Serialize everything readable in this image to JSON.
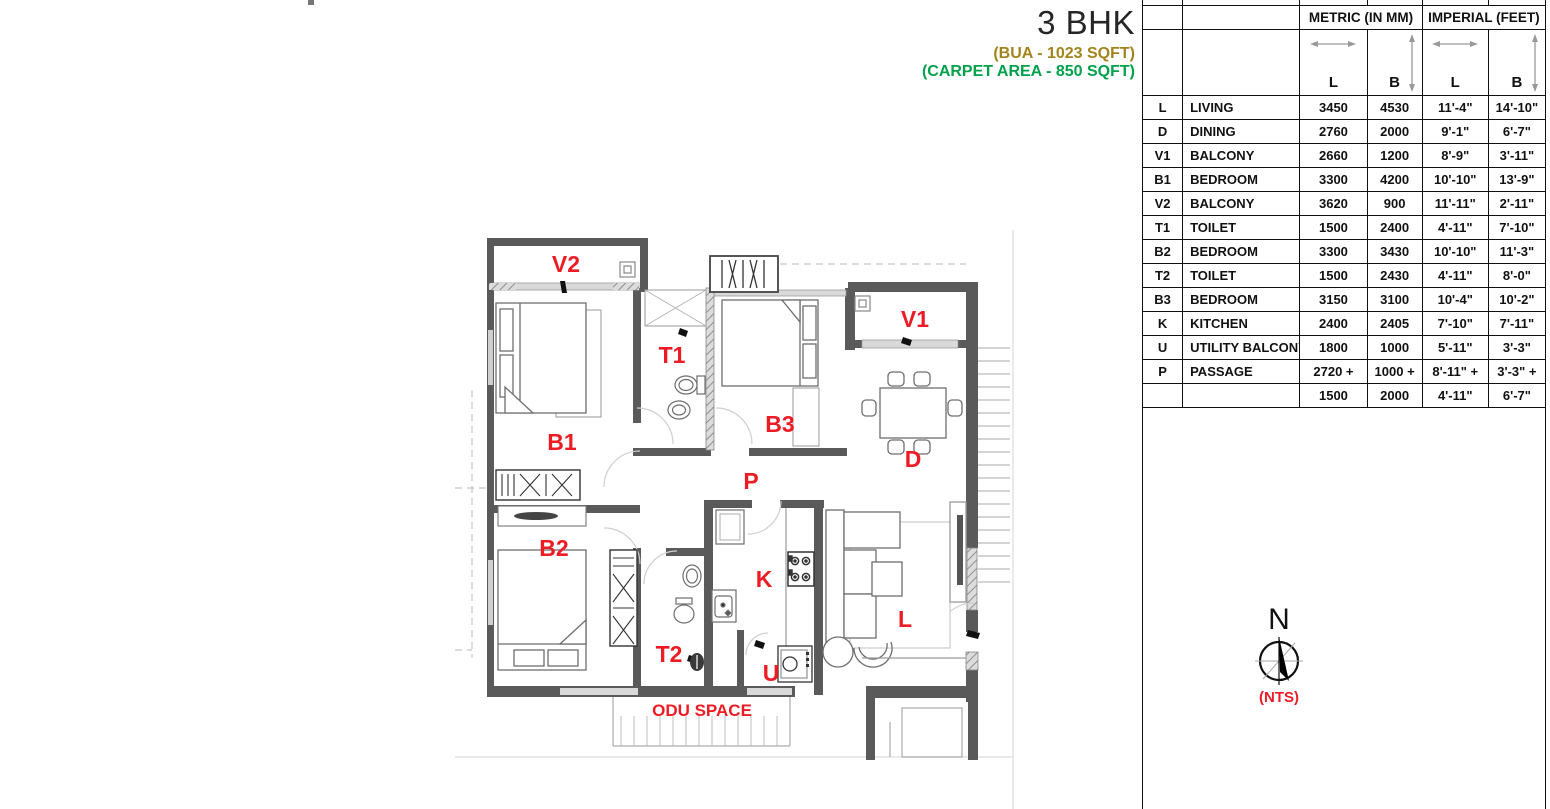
{
  "title": {
    "heading": "3 BHK",
    "bua": "(BUA - 1023 SQFT)",
    "carpet": "(CARPET AREA - 850 SQFT)"
  },
  "colors": {
    "label_red": "#ed1c24",
    "bua_gold": "#a3841c",
    "carpet_green": "#00a14b",
    "wall_gray": "#5a5a5a"
  },
  "plan": {
    "labels": {
      "v2": "V2",
      "b1": "B1",
      "t1": "T1",
      "b3": "B3",
      "v1": "V1",
      "d": "D",
      "p": "P",
      "b2": "B2",
      "t2": "T2",
      "k": "K",
      "u": "U",
      "l": "L"
    },
    "odu_space": "ODU SPACE"
  },
  "compass": {
    "north": "N",
    "scale_note": "(NTS)"
  },
  "table": {
    "group_headers": [
      "METRIC (IN MM)",
      "IMPERIAL (FEET)"
    ],
    "sub_headers": [
      "L",
      "B",
      "L",
      "B"
    ],
    "rows": [
      [
        "L",
        "LIVING",
        "3450",
        "4530",
        "11'-4\"",
        "14'-10\""
      ],
      [
        "D",
        "DINING",
        "2760",
        "2000",
        "9'-1\"",
        "6'-7\""
      ],
      [
        "V1",
        "BALCONY",
        "2660",
        "1200",
        "8'-9\"",
        "3'-11\""
      ],
      [
        "B1",
        "BEDROOM",
        "3300",
        "4200",
        "10'-10\"",
        "13'-9\""
      ],
      [
        "V2",
        "BALCONY",
        "3620",
        "900",
        "11'-11\"",
        "2'-11\""
      ],
      [
        "T1",
        "TOILET",
        "1500",
        "2400",
        "4'-11\"",
        "7'-10\""
      ],
      [
        "B2",
        "BEDROOM",
        "3300",
        "3430",
        "10'-10\"",
        "11'-3\""
      ],
      [
        "T2",
        "TOILET",
        "1500",
        "2430",
        "4'-11\"",
        "8'-0\""
      ],
      [
        "B3",
        "BEDROOM",
        "3150",
        "3100",
        "10'-4\"",
        "10'-2\""
      ],
      [
        "K",
        "KITCHEN",
        "2400",
        "2405",
        "7'-10\"",
        "7'-11\""
      ],
      [
        "U",
        "UTILITY BALCONY",
        "1800",
        "1000",
        "5'-11\"",
        "3'-3\""
      ],
      [
        "P",
        "PASSAGE",
        "2720 +",
        "1000 +",
        "8'-11\" +",
        "3'-3\" +"
      ],
      [
        "",
        "",
        "1500",
        "2000",
        "4'-11\"",
        "6'-7\""
      ]
    ]
  }
}
